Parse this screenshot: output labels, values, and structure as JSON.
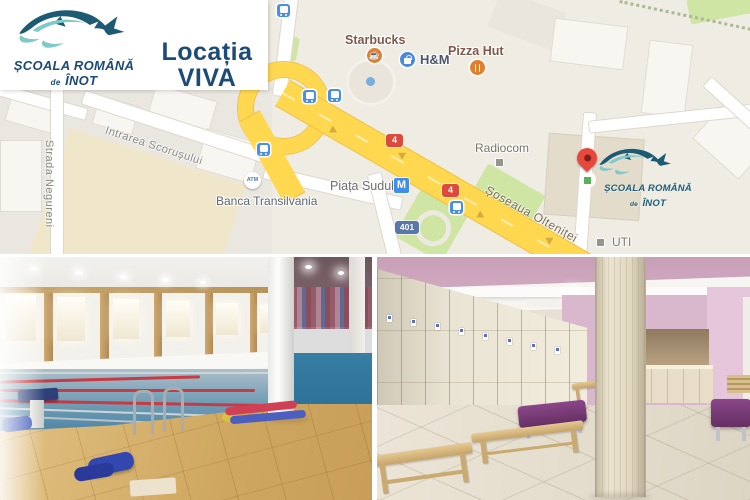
{
  "branding": {
    "school_line1": "ȘCOALA ROMÂNĂ",
    "school_de": "de",
    "school_line2": "ÎNOT",
    "location_line1": "Locația",
    "location_line2": "VIVA",
    "navy": "#1d4b78",
    "teal_dark": "#1d5a74",
    "teal_light": "#7fc9c9"
  },
  "map": {
    "pois": {
      "starbucks": "Starbucks",
      "hm": "H&M",
      "pizza_hut": "Pizza Hut",
      "radiocom": "Radiocom",
      "banca": "Banca Transilvania",
      "uti": "UTI"
    },
    "transit": {
      "metro_name": "Piața Sudului",
      "metro_letter": "M",
      "atm": "ATM"
    },
    "routes": {
      "r4": "4",
      "r401": "401"
    },
    "streets": {
      "intrarea": "Intrarea Scorușului",
      "negureni": "Strada Negureni",
      "oltenitei": "Șoseaua Olteniței"
    },
    "colors": {
      "highway_yellow": "#ffd84f",
      "park_green": "#cfe5a4",
      "transit_blue": "#4a89dd",
      "route_red": "#dd4a3d",
      "pin_red": "#e8483b"
    }
  }
}
